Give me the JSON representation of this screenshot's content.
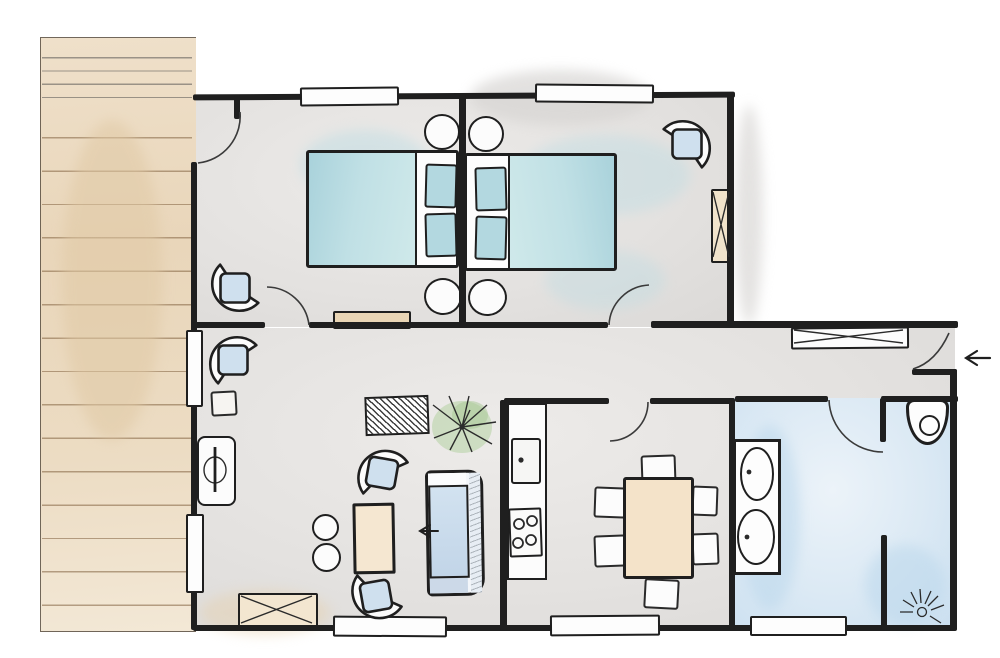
{
  "document": {
    "kind": "floor-plan-sketch",
    "style": "hand-drawn watercolor top view",
    "visible_text": "none"
  },
  "palette": {
    "wall_ink": "#1f1f1f",
    "floor_gray": "#e4e2e0",
    "bathroom_blue": "#d9e8f3",
    "deck_tan": "#e9d6ba",
    "bed_teal": "#b3d8e0",
    "upholstery_blue": "#cfe0ee",
    "wood_tan": "#f4e3c9",
    "plant_green": "#b5d1a2"
  },
  "rooms": [
    {
      "name": "deck-terrace",
      "furniture": [
        "wood planks"
      ]
    },
    {
      "name": "bedroom-left",
      "furniture": [
        "double bed",
        "two pillows",
        "bedside stool top",
        "bedside stool bottom",
        "armchair",
        "dresser",
        "window",
        "door to deck",
        "door to hallway"
      ]
    },
    {
      "name": "bedroom-right",
      "furniture": [
        "double bed",
        "two pillows",
        "bedside stool top",
        "bedside stool bottom",
        "armchair",
        "wardrobe",
        "window",
        "door to hallway"
      ]
    },
    {
      "name": "hallway",
      "furniture": [
        "sideboard cabinet",
        "entrance door"
      ]
    },
    {
      "name": "living-room",
      "furniture": [
        "sofa",
        "armchair top",
        "armchair middle",
        "armchair bottom",
        "coffee table",
        "two poufs",
        "rug",
        "plant",
        "console with lamp",
        "side table",
        "tv cabinet",
        "two wall windows",
        "bottom window"
      ]
    },
    {
      "name": "kitchen-dining",
      "furniture": [
        "counter",
        "sink",
        "stove",
        "dining table",
        "six chairs",
        "window",
        "door"
      ]
    },
    {
      "name": "bathroom",
      "furniture": [
        "vanity with two sinks",
        "toilet",
        "shower with drain",
        "partition wall",
        "window",
        "door"
      ]
    }
  ],
  "icons": [
    {
      "name": "entry-arrow-icon",
      "meaning": "entrance direction, points left into the home"
    },
    {
      "name": "sofa-arrow-icon",
      "meaning": "direction arrow pointing left beside sofa"
    },
    {
      "name": "shower-drain-icon",
      "meaning": "drain with radiating spray lines"
    },
    {
      "name": "plant-icon",
      "meaning": "potted palm plant"
    }
  ]
}
